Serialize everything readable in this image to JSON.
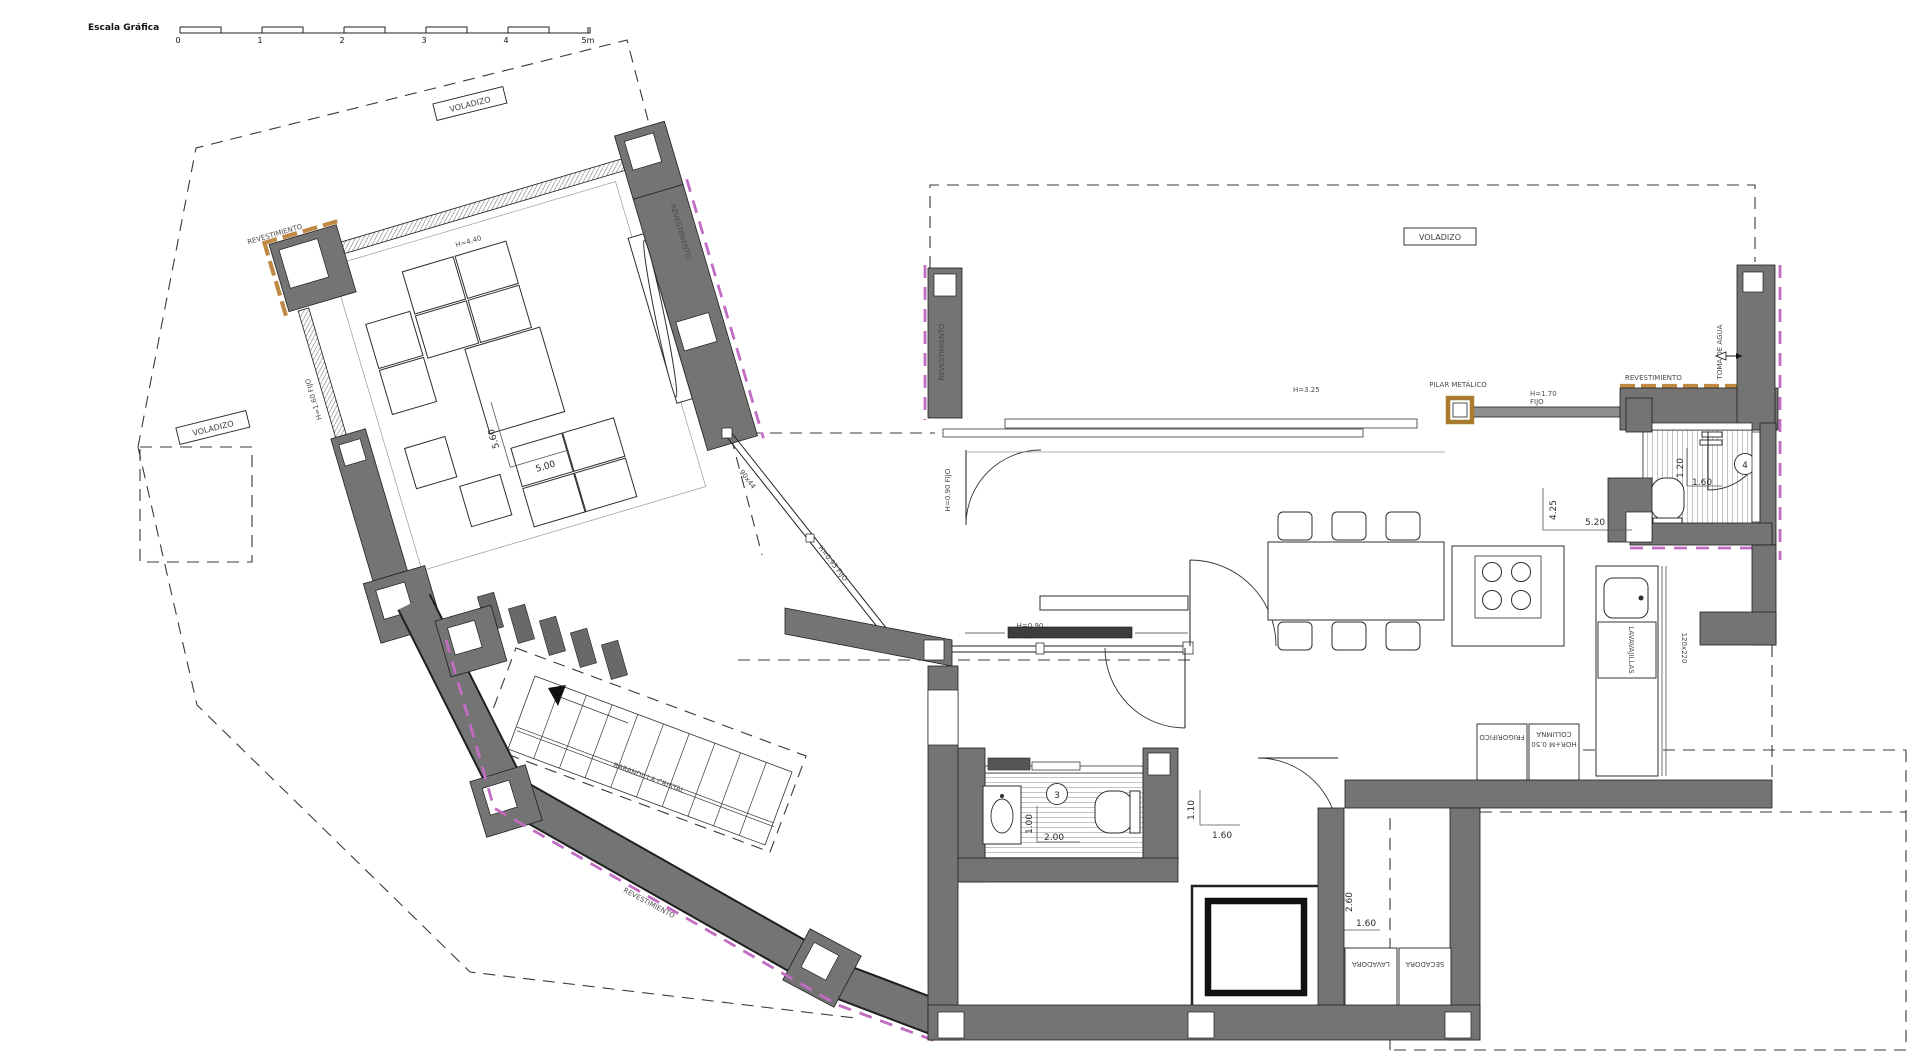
{
  "drawing": {
    "type": "architectural-floor-plan",
    "background": "#ffffff",
    "colors": {
      "wall": "#747474",
      "cladding_revestimiento": "#c08a45",
      "boundary_magenta": "#c36cc3",
      "pilar_metalico": "#a87b2e"
    }
  },
  "scale_bar": {
    "title": "Escala Gráfica",
    "ticks": {
      "t0": "0",
      "t1": "1",
      "t2": "2",
      "t3": "3",
      "t4": "4",
      "t5": "5m"
    }
  },
  "texts": {
    "voladizo_a": "VOLADIZO",
    "voladizo_b": "VOLADIZO",
    "voladizo_c": "VOLADIZO",
    "rev_a": "REVESTIMIENTO",
    "rev_b": "REVESTIMIENTO",
    "rev_c": "REVESTIMIENTO",
    "rev_d": "REVESTIMIENTO",
    "rev_e": "REVESTIMIENTO",
    "win_top_living": "H=4.40",
    "win_left_living": "H=1.60 FIJO",
    "win_slope_a": "90x44",
    "win_slope_b": "H=0.95 FIJO",
    "win_bottom_1": "H=0.90",
    "win_bottom_2": "FIJO",
    "win_door_right": "H=0.90 FIJO",
    "win_kitchen_a": "H=3.25",
    "win_kitchen_b1": "H=1.70",
    "win_kitchen_b2": "FIJO",
    "pilar": "PILAR METÁLICO",
    "toma_agua": "TOMA DE AGUA",
    "barandilla": "BARANDILLA CRISTAL",
    "lavavajillas": "LAVAVAJILLAS",
    "counter_dim": "120x220",
    "frigorifico": "FRIGORIFICO",
    "columna1": "COLUMNA",
    "columna2": "HOR+M 0.50",
    "lavadora": "LAVADORA",
    "secadora": "SECADORA"
  },
  "dimensions": {
    "living_a": "5.60",
    "living_b": "5.00",
    "kitchen_a": "4.25",
    "kitchen_b": "5.20",
    "bath4_a": "1.20",
    "bath4_b": "1.60",
    "bath3_a": "1.00",
    "bath3_b": "2.00",
    "hall_a": "1.10",
    "hall_b": "1.60",
    "laundry_a": "2.60",
    "laundry_b": "1.60"
  },
  "rooms": {
    "bath3_number": "3",
    "bath4_number": "4"
  }
}
